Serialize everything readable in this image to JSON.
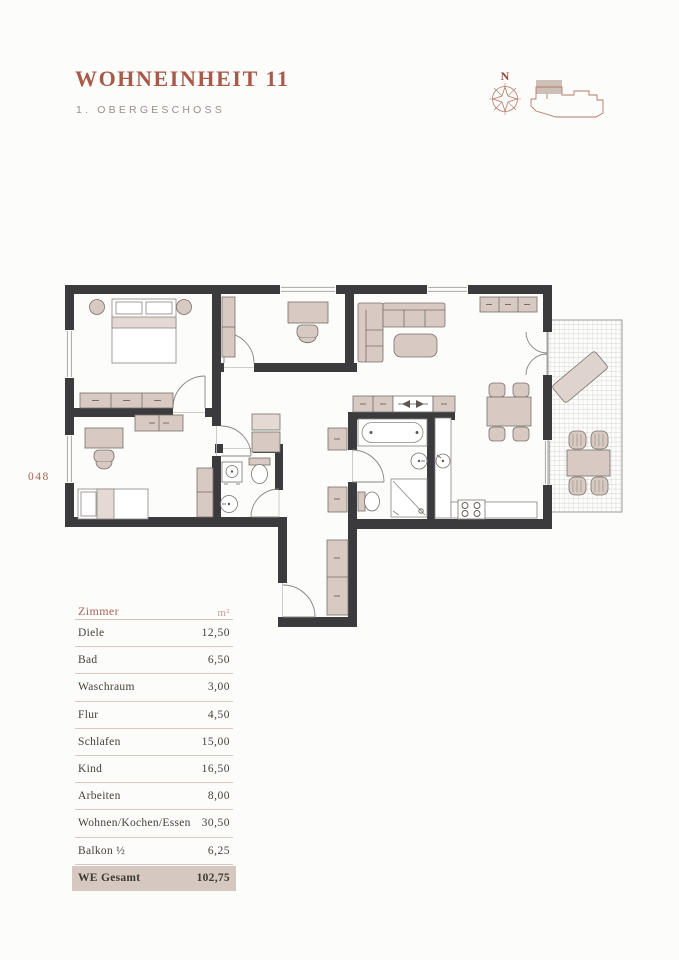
{
  "header": {
    "title": "WOHNEINHEIT 11",
    "subtitle": "1. OBERGESCHOSS",
    "compass_label": "N"
  },
  "page": {
    "number": "048"
  },
  "icons": {
    "compass": "compass-rose",
    "building": "building-footprint-locator"
  },
  "colors": {
    "accent_terracotta": "#a85948",
    "subtitle_gray": "#9b8e88",
    "wall_dark": "#3b3b3d",
    "furniture_beige": "#d8cac3",
    "table_divider": "#ddc7c0",
    "total_row_bg": "#d4c8c1",
    "locator_line": "#b5796a"
  },
  "rooms_table": {
    "col_room": "Zimmer",
    "col_area": "m²",
    "rows": [
      {
        "name": "Diele",
        "area": "12,50"
      },
      {
        "name": "Bad",
        "area": "6,50"
      },
      {
        "name": "Waschraum",
        "area": "3,00"
      },
      {
        "name": "Flur",
        "area": "4,50"
      },
      {
        "name": "Schlafen",
        "area": "15,00"
      },
      {
        "name": "Kind",
        "area": "16,50"
      },
      {
        "name": "Arbeiten",
        "area": "8,00"
      },
      {
        "name": "Wohnen/Kochen/Essen",
        "area": "30,50"
      },
      {
        "name": "Balkon ½",
        "area": "6,25"
      }
    ],
    "total": {
      "name": "WE Gesamt",
      "area": "102,75"
    }
  }
}
